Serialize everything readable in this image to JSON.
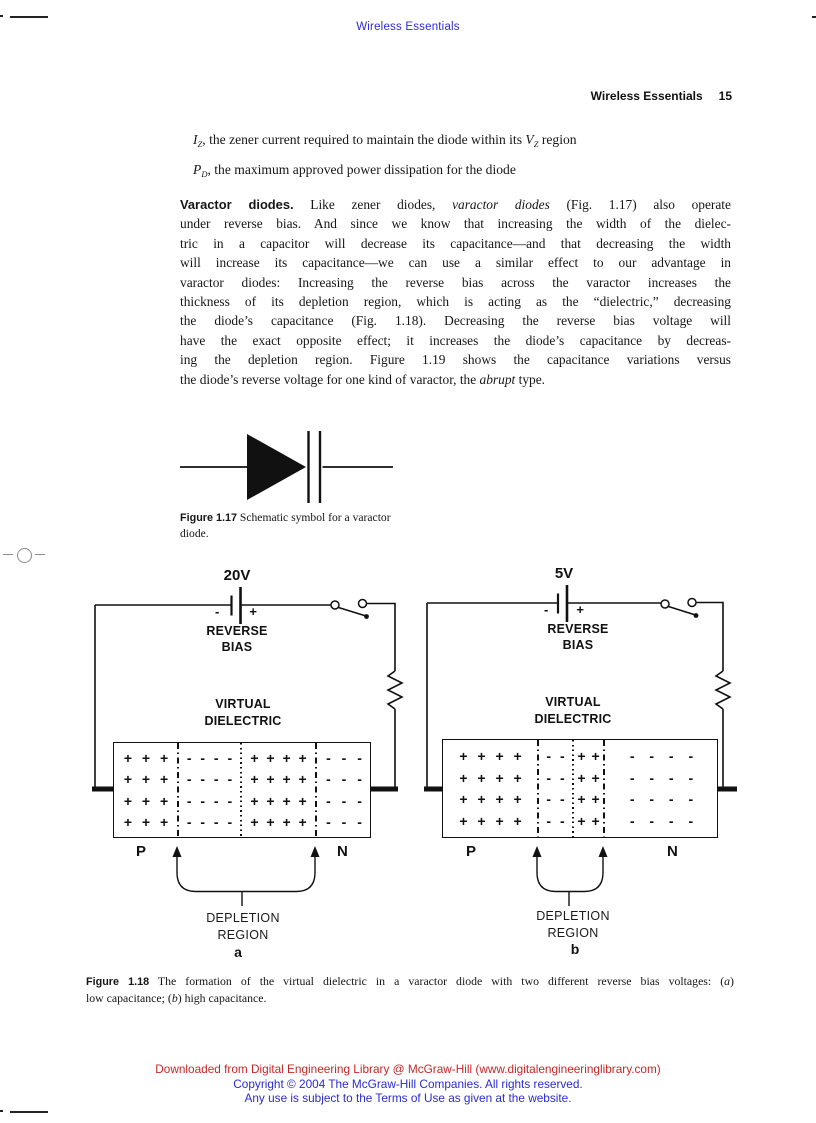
{
  "colors": {
    "ink": "#161616",
    "header_blue": "#2d2dd6",
    "footer_red": "#c62828",
    "footer_blue": "#2b2bd2"
  },
  "header": {
    "top_title": "Wireless Essentials",
    "running_title": "Wireless Essentials",
    "page_number": "15"
  },
  "lead_lines": [
    [
      {
        "t": "I",
        "i": true
      },
      {
        "t": "Z",
        "i": true,
        "sub": true
      },
      {
        "t": ", the zener current required to maintain the diode within its "
      },
      {
        "t": "V",
        "i": true
      },
      {
        "t": "Z",
        "i": true,
        "sub": true
      },
      {
        "t": " region"
      }
    ],
    [
      {
        "t": "P",
        "i": true
      },
      {
        "t": "D",
        "i": true,
        "sub": true
      },
      {
        "t": ", the maximum approved power dissipation for the diode"
      }
    ]
  ],
  "paragraph": {
    "lines": [
      [
        {
          "t": "Varactor diodes.",
          "b": true,
          "sans": true,
          "f12": true
        },
        {
          "t": "  Like zener diodes, "
        },
        {
          "t": "varactor diodes",
          "i": true
        },
        {
          "t": " (Fig. 1.17) also operate"
        }
      ],
      [
        {
          "t": "under reverse bias. And since we know that increasing the width of the dielec-"
        }
      ],
      [
        {
          "t": "tric in a capacitor will decrease its capacitance—and that decreasing the width"
        }
      ],
      [
        {
          "t": "will increase its capacitance—we can use a similar effect to our advantage in"
        }
      ],
      [
        {
          "t": "varactor diodes: Increasing the reverse bias across the varactor increases the"
        }
      ],
      [
        {
          "t": "thickness of its depletion region, which is acting as the “dielectric,” decreasing"
        }
      ],
      [
        {
          "t": "the diode’s capacitance (Fig. 1.18). Decreasing the reverse bias voltage will"
        }
      ],
      [
        {
          "t": "have the exact opposite effect; it increases the diode’s capacitance by decreas-"
        }
      ],
      [
        {
          "t": "ing the depletion region. Figure 1.19 shows the capacitance variations versus"
        }
      ],
      [
        {
          "t": "the diode’s reverse voltage for one kind of varactor, the "
        },
        {
          "t": "abrupt",
          "i": true
        },
        {
          "t": " type."
        }
      ]
    ]
  },
  "fig17": {
    "caption_lines": [
      [
        {
          "t": "Figure 1.17",
          "capnum": true
        },
        {
          "t": "   Schematic symbol for a varactor"
        }
      ],
      [
        {
          "t": "diode."
        }
      ]
    ]
  },
  "fig18": {
    "a": {
      "voltage": "20V",
      "battery_minus": "-",
      "battery_plus": "+",
      "bias_line1": "REVERSE",
      "bias_line2": "BIAS",
      "dielectric_line1": "VIRTUAL",
      "dielectric_line2": "DIELECTRIC",
      "p_label": "P",
      "n_label": "N",
      "depletion_line1": "DEPLETION",
      "depletion_line2": "REGION",
      "tag": "a",
      "regions": [
        {
          "name": "p-region",
          "row": "+ + +"
        },
        {
          "name": "depletion-negative",
          "row": "- - - -"
        },
        {
          "name": "depletion-positive",
          "row": "+ + + +"
        },
        {
          "name": "n-region",
          "row": "- - -"
        }
      ]
    },
    "b": {
      "voltage": "5V",
      "battery_minus": "-",
      "battery_plus": "+",
      "bias_line1": "REVERSE",
      "bias_line2": "BIAS",
      "dielectric_line1": "VIRTUAL",
      "dielectric_line2": "DIELECTRIC",
      "p_label": "P",
      "n_label": "N",
      "depletion_line1": "DEPLETION",
      "depletion_line2": "REGION",
      "tag": "b",
      "regions": [
        {
          "name": "p-region",
          "row": "+ + + +"
        },
        {
          "name": "depletion-negative",
          "row": "- -"
        },
        {
          "name": "depletion-positive",
          "row": "+ +"
        },
        {
          "name": "n-region",
          "row": "- - - -"
        }
      ]
    },
    "caption_lines": [
      [
        {
          "t": "Figure 1.18",
          "capnum": true
        },
        {
          "t": "   The formation of the virtual dielectric in a varactor diode with two different reverse bias voltages: ("
        },
        {
          "t": "a",
          "i": true
        },
        {
          "t": ")"
        }
      ],
      [
        {
          "t": "low capacitance; ("
        },
        {
          "t": "b",
          "i": true
        },
        {
          "t": ") high capacitance."
        }
      ]
    ]
  },
  "footer": {
    "line1": "Downloaded from Digital Engineering Library @ McGraw-Hill (www.digitalengineeringlibrary.com)",
    "line2": "Copyright © 2004 The McGraw-Hill Companies. All rights reserved.",
    "line3": "Any use is subject to the Terms of Use as given at the website."
  }
}
